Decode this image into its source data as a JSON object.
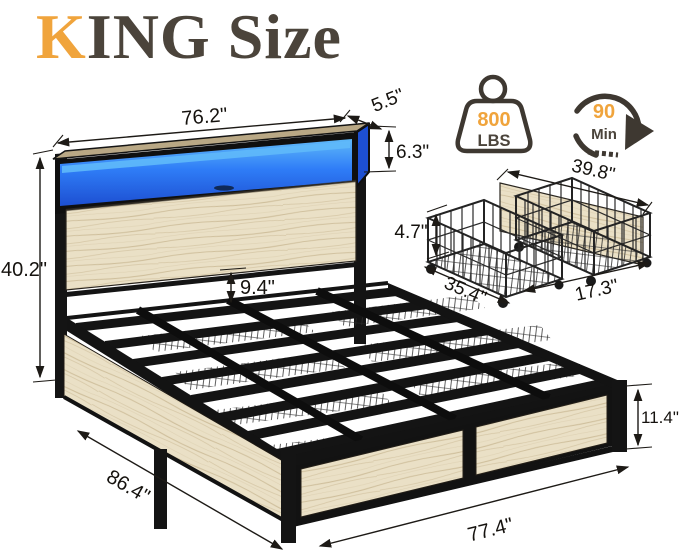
{
  "title": {
    "accent_letter": "K",
    "rest": "ING Size"
  },
  "badges": {
    "weight_capacity": {
      "icon": "weight-kettlebell-icon",
      "value": "800",
      "unit": "LBS"
    },
    "assembly_time": {
      "icon": "clock-rotation-arrow-icon",
      "value": "90",
      "unit": "Min"
    }
  },
  "bed": {
    "dim_headboard_width": "76.2\"",
    "dim_shelf_depth": "5.5\"",
    "dim_shelf_height": "6.3\"",
    "dim_total_height": "40.2\"",
    "dim_clearance": "9.4\"",
    "dim_length": "86.4\"",
    "dim_width": "77.4\"",
    "dim_footboard_height": "11.4\""
  },
  "drawer": {
    "dim_panel_width": "39.8\"",
    "dim_height": "4.7\"",
    "dim_length": "35.4\"",
    "dim_depth": "17.3\""
  },
  "colors": {
    "accent": "#F0A43C",
    "ink": "#4B443B",
    "line": "#1D1A16",
    "metal": "#141414",
    "badge": "#3E3831",
    "wood": "#EAE0C6",
    "wood-grain": "#CFBF9C",
    "wood-dark": "#B9A885",
    "led-light": "#5FB9F9",
    "led-mid": "#2F7DF7",
    "led-deep": "#1D4FD2"
  }
}
